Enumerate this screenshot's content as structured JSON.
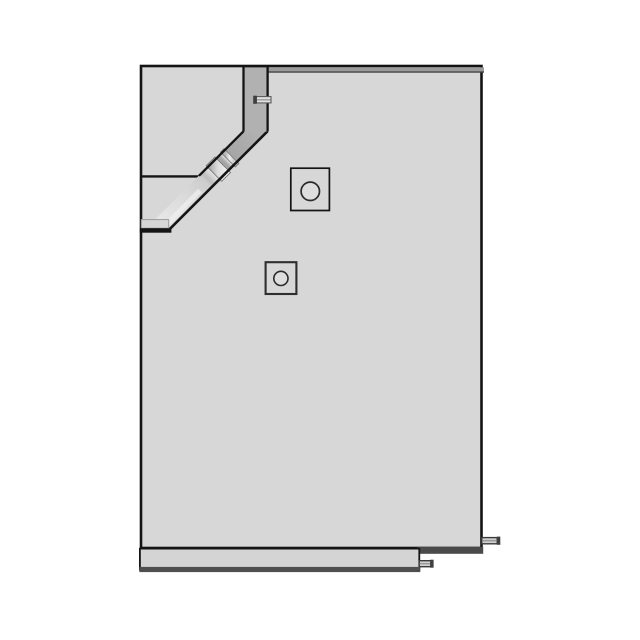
{
  "drawing": {
    "kind": "technical-part-view",
    "subject": "equipment-housing-side-panel-with-chute"
  },
  "icons": {
    "upper_port": "square-with-circle",
    "lower_port": "square-with-circle"
  },
  "colors": {
    "background": "#ffffff",
    "outline": "#141414",
    "panel": "#d7d7d7",
    "duct_dark": "#b1b1b1",
    "duct_light_end": "#e6e6e6",
    "lip": "#9b9b9b",
    "lip_shadow": "#3d3d3d",
    "shelf_line": "#141414",
    "ledge": "#d6d6d6",
    "mouth_edge": "#141414",
    "ring_light": "#efefef",
    "sleeve_light": "#f4f4f4",
    "sleeve_dark": "#ababab",
    "highlight": "#f0f0f0",
    "square_fill": "#d7d7d7",
    "circle_fill": "#dedede",
    "dark_band": "#4a4a4a",
    "base": "#d4d4d4",
    "base_band": "#4f4f4f",
    "peg_fill": "#d2d2d2",
    "peg_stripe": "#9a9a9a",
    "peg_cap": "#3f3f3f",
    "tab_fill": "#e2e2e2"
  }
}
